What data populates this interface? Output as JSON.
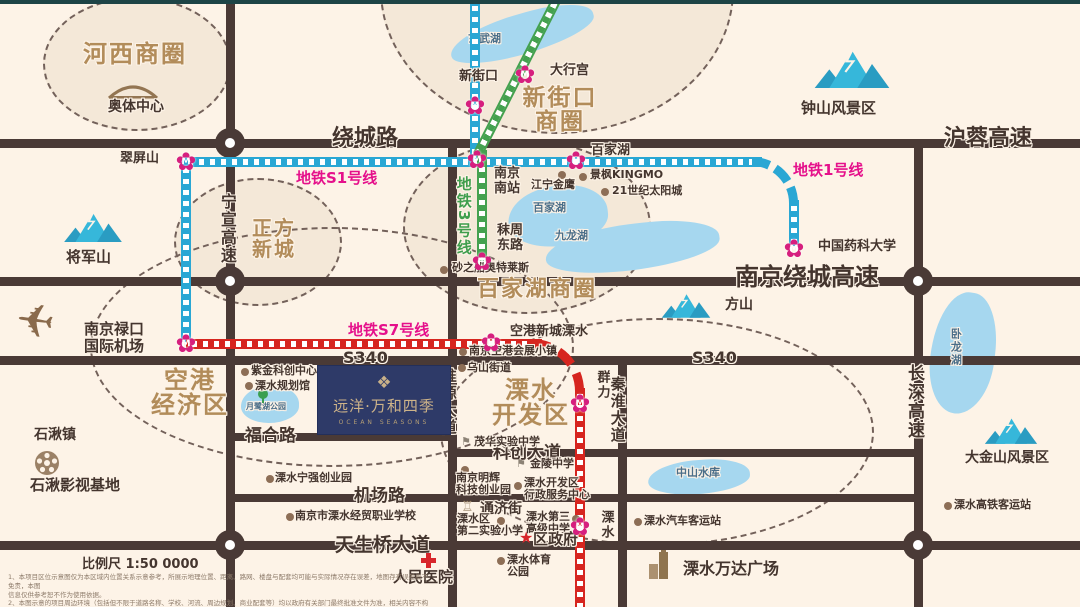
{
  "logo": {
    "mark": "❖",
    "title": "远洋·万和四季",
    "subtitle": "OCEAN SEASONS"
  },
  "legend": {
    "scale_text": "比例尺 1:50 0000",
    "disclaimer_lines": [
      "1、本项目区位示意图仅为本区域内位置关系示意参考，所展示地理位置、距离、路网、楼盘与配套均可能与实际情况存在误差，地图存有误差概不免责，本图",
      "信息仅供参考恕不作为使用依据。",
      "2、本图示意的项目周边环境（包括但不限于道路名称、学校、河流、周边规划、商业配套等）均以政府有关部门最终批准文件为准，相关内容不构成任何要约或承诺。",
      "3、本项目区位图为手绘示意图仅供参考，未尽事宜以政府有关部门批准文件及双方签订的商品房买卖合同约定为准，手绘图本公司保留修订权利。"
    ]
  },
  "palette": {
    "road": "#4a3a36",
    "rail_blue": "#2aa7d4",
    "rail_green": "#44a14f",
    "rail_red": "#d6251f",
    "station_pink": "#d61f7e",
    "zone_text": "#b28c5a",
    "line_label_pink": "#e5108b",
    "mountain_light": "#36b7da",
    "mountain_dark": "#2a9cc2",
    "lake": "#a6d7ef",
    "poi_dot": "#8d6e56"
  },
  "map": {
    "roads": [
      {
        "name": "raochenglu-hurong-gaosu",
        "x": 0,
        "y": 139,
        "w": 1080,
        "h": 9
      },
      {
        "name": "nanjing-raocheng-gaosu",
        "x": 0,
        "y": 277,
        "w": 1080,
        "h": 9
      },
      {
        "name": "s340",
        "x": 0,
        "y": 356,
        "w": 1080,
        "h": 9
      },
      {
        "name": "fuhe-lu",
        "x": 226,
        "y": 433,
        "w": 226,
        "h": 8
      },
      {
        "name": "kechuang-dadao",
        "x": 448,
        "y": 449,
        "w": 470,
        "h": 8
      },
      {
        "name": "jichang-lu",
        "x": 226,
        "y": 494,
        "w": 692,
        "h": 8
      },
      {
        "name": "tianshengqiao-dadao",
        "x": 0,
        "y": 541,
        "w": 1080,
        "h": 9
      },
      {
        "name": "ningxuan-gaosu",
        "x": 226,
        "y": 0,
        "w": 9,
        "h": 607
      },
      {
        "name": "huaiyuan-dadao",
        "x": 448,
        "y": 139,
        "w": 9,
        "h": 468
      },
      {
        "name": "qinhuai-dadao",
        "x": 618,
        "y": 356,
        "w": 9,
        "h": 251
      },
      {
        "name": "changshen-gaosu",
        "x": 914,
        "y": 139,
        "w": 9,
        "h": 468
      }
    ],
    "junctions": [
      {
        "x": 230,
        "y": 143
      },
      {
        "x": 230,
        "y": 281
      },
      {
        "x": 230,
        "y": 545
      },
      {
        "x": 918,
        "y": 281
      },
      {
        "x": 918,
        "y": 545
      }
    ],
    "rails": [
      {
        "name": "line1-north",
        "c": "rail_blue",
        "type": "v",
        "x": 470,
        "y": 0,
        "len": 160
      },
      {
        "name": "s1-line1-east",
        "c": "rail_blue",
        "type": "h",
        "x": 182,
        "y": 157,
        "len": 580
      },
      {
        "name": "line1-curve",
        "c": "rail_blue",
        "type": "curve",
        "x": 752,
        "y": 157,
        "r": 46
      },
      {
        "name": "line1-yaoke",
        "c": "rail_blue",
        "type": "v",
        "x": 789,
        "y": 200,
        "len": 46
      },
      {
        "name": "s1-south",
        "c": "rail_blue",
        "type": "v",
        "x": 181,
        "y": 162,
        "len": 180
      },
      {
        "name": "line3-diag",
        "c": "rail_green",
        "type": "diag",
        "x": 562,
        "y": 0,
        "len": 176,
        "angle": 117
      },
      {
        "name": "line3-south",
        "c": "rail_green",
        "type": "v",
        "x": 477,
        "y": 150,
        "len": 115
      },
      {
        "name": "s7-west",
        "c": "rail_red",
        "type": "h",
        "x": 186,
        "y": 339,
        "len": 356
      },
      {
        "name": "s7-curve",
        "c": "rail_red",
        "type": "curve",
        "x": 532,
        "y": 339,
        "r": 52
      },
      {
        "name": "s7-south",
        "c": "rail_red",
        "type": "v",
        "x": 575,
        "y": 388,
        "len": 219
      }
    ],
    "zones": [
      {
        "lines": [
          "河西商圈"
        ],
        "cx": 135,
        "cy": 62,
        "rx": 92,
        "ry": 65,
        "lx": 83,
        "ly": 42,
        "s": 24,
        "fill": true
      },
      {
        "lines": [
          "新街口",
          "商圈"
        ],
        "cx": 555,
        "cy": -12,
        "rx": 175,
        "ry": 142,
        "lx": 505,
        "ly": 86,
        "w": 110,
        "s": 23,
        "fill": true
      },
      {
        "lines": [
          "正方",
          "新城"
        ],
        "cx": 256,
        "cy": 240,
        "rx": 82,
        "ry": 62,
        "lx": 245,
        "ly": 218,
        "w": 58,
        "s": 20,
        "fill": true
      },
      {
        "lines": [
          "百家湖商圈"
        ],
        "cx": 525,
        "cy": 225,
        "rx": 122,
        "ry": 85,
        "lx": 477,
        "ly": 278,
        "s": 22,
        "fill": true
      },
      {
        "lines": [
          "空港",
          "经济区"
        ],
        "cx": 330,
        "cy": 345,
        "rx": 240,
        "ry": 118,
        "lx": 145,
        "ly": 368,
        "w": 90,
        "s": 24,
        "fill": false
      },
      {
        "lines": [
          "溧水",
          "开发区"
        ],
        "cx": 655,
        "cy": 430,
        "rx": 215,
        "ry": 112,
        "lx": 481,
        "ly": 378,
        "w": 100,
        "s": 24,
        "fill": false
      }
    ],
    "lakes": [
      {
        "label": "玄武湖",
        "x": 448,
        "y": 14,
        "w": 148,
        "h": 40,
        "rot": -16,
        "lx": 468,
        "ly": 33
      },
      {
        "label": "百家湖",
        "x": 508,
        "y": 186,
        "w": 100,
        "h": 60,
        "rot": -6,
        "lx": 533,
        "ly": 202
      },
      {
        "label": "九龙湖",
        "x": 545,
        "y": 224,
        "w": 175,
        "h": 46,
        "rot": -7,
        "lx": 555,
        "ly": 230
      },
      {
        "label": "卧龙湖",
        "x": 931,
        "y": 292,
        "w": 64,
        "h": 122,
        "rot": 7,
        "lx": 949,
        "ly": 328,
        "vertical": true
      },
      {
        "label": "中山水库",
        "x": 648,
        "y": 460,
        "w": 102,
        "h": 34,
        "rot": -4,
        "lx": 676,
        "ly": 467
      },
      {
        "label": "月鹭湖公园",
        "x": 241,
        "y": 386,
        "w": 58,
        "h": 37,
        "rot": 0,
        "lx": 246,
        "ly": 403,
        "small": true
      }
    ],
    "mountains": [
      {
        "label": "钟山风景区",
        "x": 812,
        "y": 44,
        "w": 80,
        "lx": 801,
        "ly": 100,
        "s": 15
      },
      {
        "label": "将军山",
        "x": 62,
        "y": 208,
        "w": 62,
        "lx": 66,
        "ly": 249,
        "s": 15
      },
      {
        "label": "方山",
        "x": 660,
        "y": 289,
        "w": 52,
        "lx": 725,
        "ly": 298,
        "s": 14
      },
      {
        "label": "大金山风景区",
        "x": 983,
        "y": 413,
        "w": 56,
        "lx": 965,
        "ly": 451,
        "s": 14
      }
    ],
    "stations": [
      {
        "lines": [
          "新街口"
        ],
        "cx": 475,
        "cy": 106,
        "lx": 459,
        "ly": 70
      },
      {
        "lines": [
          "大行宫"
        ],
        "cx": 525,
        "cy": 75,
        "lx": 550,
        "ly": 64
      },
      {
        "lines": [
          "南京",
          "南站"
        ],
        "cx": 477,
        "cy": 160,
        "lx": 494,
        "ly": 167
      },
      {
        "lines": [
          "百家湖"
        ],
        "cx": 576,
        "cy": 161,
        "lx": 591,
        "ly": 144
      },
      {
        "lines": [
          "翠屏山"
        ],
        "cx": 186,
        "cy": 162,
        "lx": 120,
        "ly": 152
      },
      {
        "lines": [
          "秣周",
          "东路"
        ],
        "cx": 482,
        "cy": 262,
        "lx": 497,
        "ly": 224
      },
      {
        "lines": [
          "中国药科大学"
        ],
        "cx": 794,
        "cy": 249,
        "lx": 818,
        "ly": 240
      },
      {
        "lines": [],
        "cx": 186,
        "cy": 344
      },
      {
        "lines": [
          "空港新城溧水"
        ],
        "cx": 491,
        "cy": 343,
        "lx": 510,
        "ly": 325
      },
      {
        "lines": [
          "群力"
        ],
        "cx": 580,
        "cy": 404,
        "lx": 594,
        "ly": 370,
        "vertical": true
      },
      {
        "lines": [
          "溧水"
        ],
        "cx": 580,
        "cy": 527,
        "lx": 598,
        "ly": 510,
        "vertical": true
      }
    ],
    "line_labels": [
      {
        "text": "地铁S1号线",
        "x": 296,
        "y": 170,
        "cls": "pink-lbl"
      },
      {
        "text": "地铁1号线",
        "x": 793,
        "y": 162,
        "cls": "pink-lbl"
      },
      {
        "text": "地铁S7号线",
        "x": 348,
        "y": 322,
        "cls": "pink-lbl"
      },
      {
        "text": "地铁3号线",
        "x": 455,
        "y": 176,
        "cls": "green-lbl",
        "vertical": true
      }
    ],
    "road_labels": [
      {
        "text": "绕城路",
        "x": 332,
        "y": 127,
        "s": 22
      },
      {
        "text": "沪蓉高速",
        "x": 944,
        "y": 127,
        "s": 22
      },
      {
        "text": "南京绕城高速",
        "x": 735,
        "y": 264,
        "s": 24
      },
      {
        "text": "S340",
        "x": 343,
        "y": 349,
        "s": 16
      },
      {
        "text": "S340",
        "x": 692,
        "y": 349,
        "s": 16
      },
      {
        "text": "福合路",
        "x": 245,
        "y": 427,
        "s": 17
      },
      {
        "text": "科创大道",
        "x": 493,
        "y": 444,
        "s": 17
      },
      {
        "text": "机场路",
        "x": 354,
        "y": 487,
        "s": 17
      },
      {
        "text": "天生桥大道",
        "x": 335,
        "y": 535,
        "s": 19
      },
      {
        "text": "宁宣高速",
        "x": 218,
        "y": 193,
        "s": 16,
        "vertical": true
      },
      {
        "text": "淮源大道",
        "x": 440,
        "y": 368,
        "s": 15,
        "vertical": true
      },
      {
        "text": "秦淮大道",
        "x": 609,
        "y": 376,
        "s": 15,
        "vertical": true
      },
      {
        "text": "长深高速",
        "x": 904,
        "y": 364,
        "s": 17,
        "vertical": true
      }
    ],
    "pois": [
      {
        "lines": [
          "奥体中心"
        ],
        "icon": "stadium",
        "ix": 106,
        "iy": 84,
        "lx": 108,
        "ly": 100,
        "s": 14
      },
      {
        "lines": [
          "江宁金鹰"
        ],
        "icon": "dot",
        "ix": 558,
        "iy": 171,
        "lx": 531,
        "ly": 179
      },
      {
        "lines": [
          "景枫KINGMO"
        ],
        "icon": "dot",
        "ix": 579,
        "iy": 173,
        "lx": 590,
        "ly": 169
      },
      {
        "lines": [
          "21世纪太阳城"
        ],
        "icon": "dot",
        "ix": 601,
        "iy": 188,
        "lx": 612,
        "ly": 185
      },
      {
        "lines": [
          "砂之船奥特莱斯"
        ],
        "icon": "dot",
        "ix": 440,
        "iy": 266,
        "lx": 452,
        "ly": 262
      },
      {
        "lines": [
          "南京禄口",
          "国际机场"
        ],
        "icon": "plane",
        "ix": 16,
        "iy": 298,
        "lx": 84,
        "ly": 321,
        "s": 15
      },
      {
        "lines": [
          "紫金科创中心"
        ],
        "icon": "dot",
        "ix": 241,
        "iy": 368,
        "lx": 251,
        "ly": 365
      },
      {
        "lines": [
          "溧水规划馆"
        ],
        "icon": "dot",
        "ix": 245,
        "iy": 382,
        "lx": 255,
        "ly": 380
      },
      {
        "lines": [],
        "icon": "tree",
        "ix": 257,
        "iy": 389
      },
      {
        "lines": [
          "石湫镇"
        ],
        "icon": "none",
        "ix": 0,
        "iy": 0,
        "lx": 34,
        "ly": 428,
        "s": 14
      },
      {
        "lines": [
          "石湫影视基地"
        ],
        "icon": "reel",
        "ix": 34,
        "iy": 450,
        "lx": 30,
        "ly": 477,
        "s": 15
      },
      {
        "lines": [
          "溧水宁强创业园"
        ],
        "icon": "dot",
        "ix": 266,
        "iy": 475,
        "lx": 275,
        "ly": 472
      },
      {
        "lines": [
          "南京空港会展小镇"
        ],
        "icon": "dot",
        "ix": 459,
        "iy": 348,
        "lx": 469,
        "ly": 345
      },
      {
        "lines": [
          "乌山街道"
        ],
        "icon": "dot",
        "ix": 458,
        "iy": 364,
        "lx": 467,
        "ly": 362
      },
      {
        "lines": [
          "茂华实验中学"
        ],
        "icon": "school",
        "ix": 461,
        "iy": 436,
        "lx": 474,
        "ly": 436
      },
      {
        "lines": [
          "金陵中学"
        ],
        "icon": "school",
        "ix": 516,
        "iy": 458,
        "lx": 530,
        "ly": 458
      },
      {
        "lines": [
          "南京明辉",
          "科技创业园"
        ],
        "icon": "dot",
        "ix": 461,
        "iy": 466,
        "lx": 456,
        "ly": 472
      },
      {
        "lines": [
          "溧水开发区",
          "行政服务中心"
        ],
        "icon": "dot",
        "ix": 514,
        "iy": 482,
        "lx": 524,
        "ly": 477
      },
      {
        "lines": [
          "通济街"
        ],
        "icon": "tower",
        "ix": 461,
        "iy": 500,
        "lx": 480,
        "ly": 502,
        "s": 14
      },
      {
        "lines": [
          "溧水区",
          "第二实验小学"
        ],
        "icon": "dot",
        "ix": 497,
        "iy": 517,
        "lx": 457,
        "ly": 513
      },
      {
        "lines": [
          "溧水第三",
          "高级中学"
        ],
        "icon": "dot",
        "ix": 572,
        "iy": 515,
        "lx": 526,
        "ly": 511
      },
      {
        "lines": [
          "区政府"
        ],
        "icon": "star",
        "ix": 519,
        "iy": 530,
        "lx": 533,
        "ly": 531,
        "s": 15
      },
      {
        "lines": [
          "溧水汽车客运站"
        ],
        "icon": "dot",
        "ix": 634,
        "iy": 518,
        "lx": 644,
        "ly": 515
      },
      {
        "lines": [
          "人民医院"
        ],
        "icon": "cross",
        "ix": 421,
        "iy": 553,
        "lx": 393,
        "ly": 569,
        "s": 15
      },
      {
        "lines": [
          "溧水体育",
          "公园"
        ],
        "icon": "dot",
        "ix": 497,
        "iy": 557,
        "lx": 507,
        "ly": 554
      },
      {
        "lines": [
          "溧水万达广场"
        ],
        "icon": "building",
        "ix": 648,
        "iy": 550,
        "lx": 683,
        "ly": 560,
        "s": 16
      },
      {
        "lines": [
          "溧水高铁客运站"
        ],
        "icon": "dot",
        "ix": 944,
        "iy": 502,
        "lx": 954,
        "ly": 499
      },
      {
        "lines": [
          "南京市溧水经贸职业学校"
        ],
        "icon": "dot",
        "ix": 286,
        "iy": 513,
        "lx": 295,
        "ly": 510
      }
    ]
  }
}
